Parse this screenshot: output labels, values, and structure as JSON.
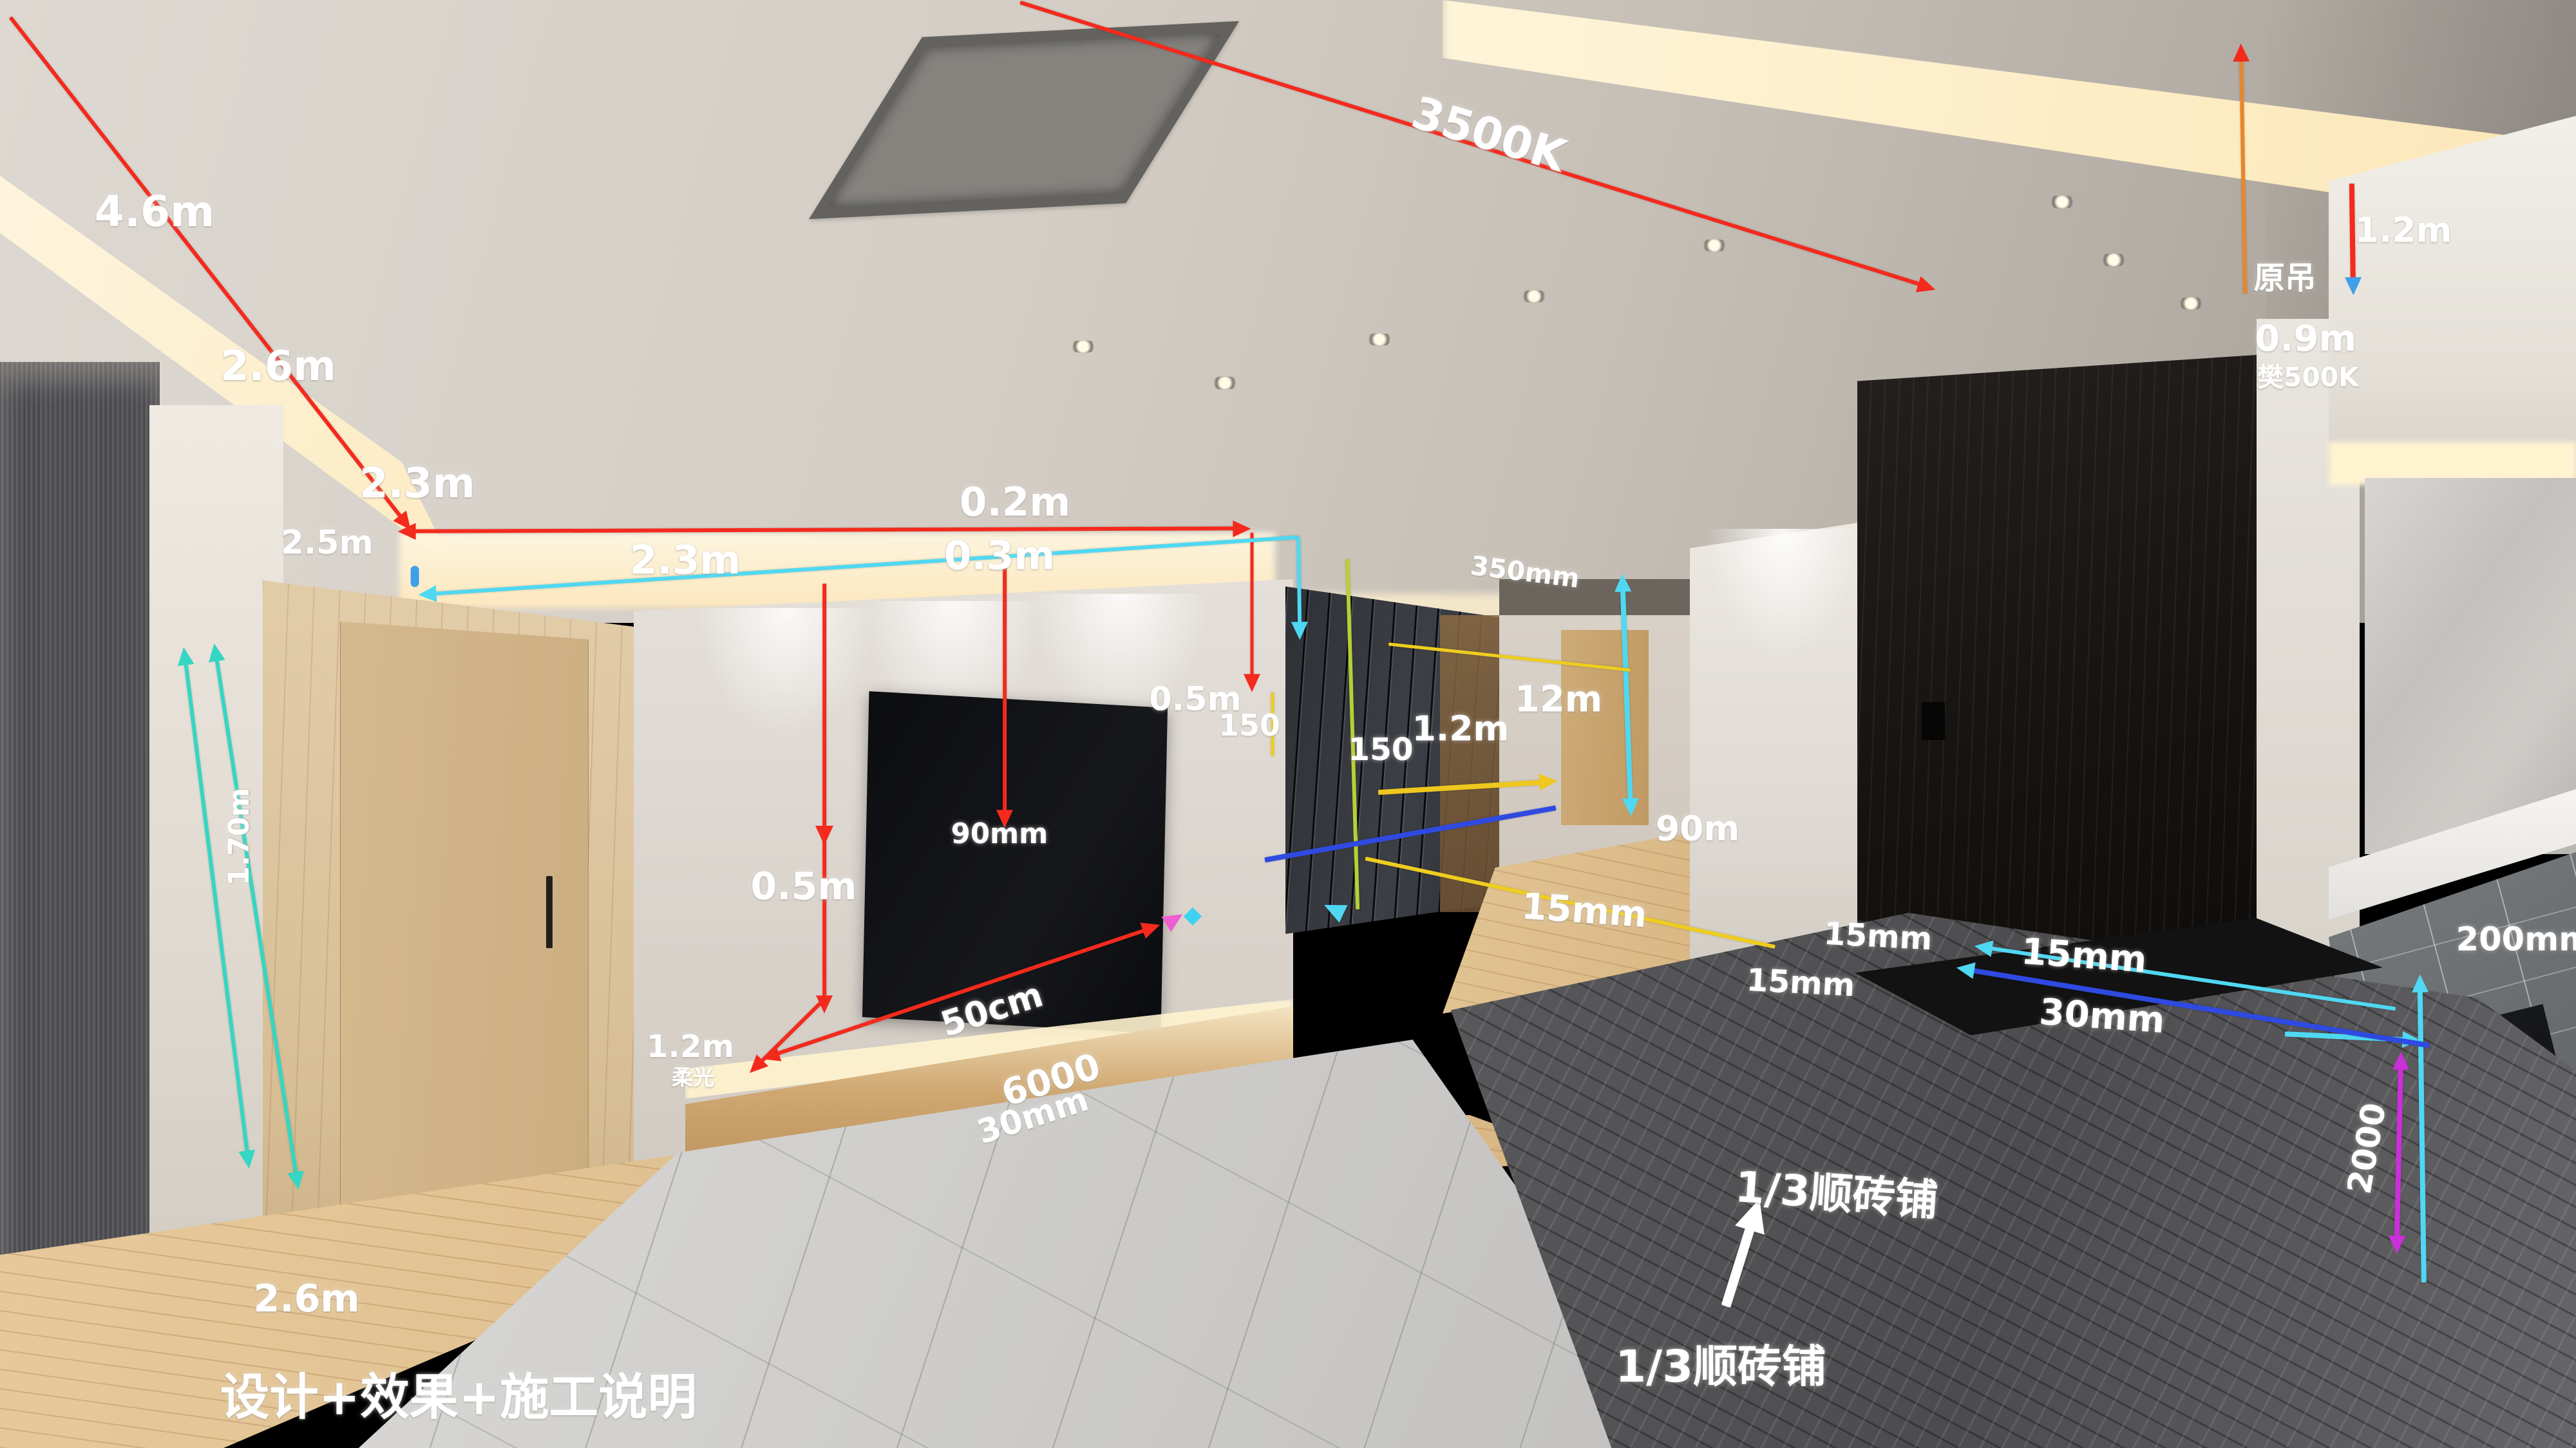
{
  "caption": {
    "text": "设计+效果+施工说明"
  },
  "colors": {
    "red": "#f42a1d",
    "cyan": "#4fd8f2",
    "teal": "#35d6c3",
    "yellow": "#eecd1f",
    "yellow_green": "#b8cf35",
    "blue": "#2f4ae0",
    "magenta": "#cb2fd9",
    "orange": "#e8862c",
    "light_blue": "#3f9fe8",
    "pink": "#ee5fd2",
    "white": "#ffffff"
  },
  "annotations": {
    "labels": [
      {
        "name": "dim-4-6m",
        "text": "4.6m",
        "x": 6.0,
        "y": 14.6,
        "size": 26,
        "rot": 0
      },
      {
        "name": "dim-2-6m-ceiling",
        "text": "2.6m",
        "x": 10.8,
        "y": 25.3,
        "size": 25,
        "rot": 0
      },
      {
        "name": "dim-2-3m-ceiling",
        "text": "2.3m",
        "x": 16.2,
        "y": 33.4,
        "size": 25,
        "rot": 0
      },
      {
        "name": "dim-2-5m",
        "text": "2.5m",
        "x": 12.7,
        "y": 37.5,
        "size": 20,
        "rot": 0
      },
      {
        "name": "dim-0-2m",
        "text": "0.2m",
        "x": 39.4,
        "y": 34.7,
        "size": 24,
        "rot": 0
      },
      {
        "name": "dim-0-3m",
        "text": "0.3m",
        "x": 38.8,
        "y": 38.4,
        "size": 24,
        "rot": 0
      },
      {
        "name": "dim-3500k",
        "text": "3500K",
        "x": 57.8,
        "y": 9.3,
        "size": 27,
        "rot": 17
      },
      {
        "name": "dim-2-3m-cove",
        "text": "2.3m",
        "x": 26.6,
        "y": 38.7,
        "size": 24,
        "rot": 0
      },
      {
        "name": "dim-1-70m",
        "text": "1.70m",
        "x": 9.3,
        "y": 57.8,
        "size": 17,
        "rot": -90
      },
      {
        "name": "dim-2-6m-floor",
        "text": "2.6m",
        "x": 11.9,
        "y": 89.7,
        "size": 23,
        "rot": 0
      },
      {
        "name": "dim-0-5m-tvwall",
        "text": "0.5m",
        "x": 31.2,
        "y": 61.2,
        "size": 23,
        "rot": 0
      },
      {
        "name": "dim-90mm",
        "text": "90mm",
        "x": 38.8,
        "y": 57.6,
        "size": 17,
        "rot": 0
      },
      {
        "name": "dim-50cm",
        "text": "50cm",
        "x": 38.5,
        "y": 69.7,
        "size": 21,
        "rot": -18
      },
      {
        "name": "dim-6000",
        "text": "6000",
        "x": 40.8,
        "y": 74.6,
        "size": 22,
        "rot": -17
      },
      {
        "name": "dim-30mm-console",
        "text": "30mm",
        "x": 40.1,
        "y": 77.1,
        "size": 20,
        "rot": -18
      },
      {
        "name": "dim-1-2m-console",
        "text": "1.2m",
        "x": 26.8,
        "y": 72.3,
        "size": 19,
        "rot": 0
      },
      {
        "name": "label-rouguang",
        "text": "柔光",
        "x": 26.9,
        "y": 74.3,
        "size": 13,
        "rot": 0
      },
      {
        "name": "dim-150-tvwall",
        "text": "150",
        "x": 48.5,
        "y": 50.1,
        "size": 18,
        "rot": 0
      },
      {
        "name": "dim-0-5m-cabinet",
        "text": "0.5m",
        "x": 46.4,
        "y": 48.3,
        "size": 20,
        "rot": 0
      },
      {
        "name": "dim-350mm",
        "text": "350mm",
        "x": 59.2,
        "y": 39.5,
        "size": 16,
        "rot": 7
      },
      {
        "name": "dim-150-cabinet",
        "text": "150",
        "x": 53.6,
        "y": 51.8,
        "size": 19,
        "rot": 0
      },
      {
        "name": "dim-1-2m-cabinet",
        "text": "1.2m",
        "x": 56.7,
        "y": 50.3,
        "size": 21,
        "rot": 0
      },
      {
        "name": "dim-12m",
        "text": "12m",
        "x": 60.5,
        "y": 48.3,
        "size": 22,
        "rot": 0
      },
      {
        "name": "dim-90m",
        "text": "90m",
        "x": 65.9,
        "y": 57.2,
        "size": 21,
        "rot": 0
      },
      {
        "name": "dim-15mm-hall",
        "text": "15mm",
        "x": 61.5,
        "y": 62.9,
        "size": 22,
        "rot": 4
      },
      {
        "name": "dim-15mm-wall",
        "text": "15mm",
        "x": 72.9,
        "y": 64.7,
        "size": 19,
        "rot": 3
      },
      {
        "name": "dim-15mm-floor",
        "text": "15mm",
        "x": 69.9,
        "y": 67.9,
        "size": 19,
        "rot": 3
      },
      {
        "name": "dim-15mm-door",
        "text": "15mm",
        "x": 80.9,
        "y": 66.0,
        "size": 22,
        "rot": 4
      },
      {
        "name": "dim-30mm-door",
        "text": "30mm",
        "x": 81.6,
        "y": 70.2,
        "size": 22,
        "rot": 4
      },
      {
        "name": "label-yuandiao",
        "text": "原吊",
        "x": 88.7,
        "y": 19.0,
        "size": 19,
        "rot": 0
      },
      {
        "name": "dim-1-2m-right",
        "text": "1.2m",
        "x": 93.3,
        "y": 15.9,
        "size": 21,
        "rot": 0
      },
      {
        "name": "dim-0-9m",
        "text": "0.9m",
        "x": 89.5,
        "y": 23.4,
        "size": 22,
        "rot": 0
      },
      {
        "name": "dim-500k-right",
        "text": "樊500K",
        "x": 89.6,
        "y": 25.9,
        "size": 16,
        "rot": 0
      },
      {
        "name": "dim-200mm",
        "text": "200mm",
        "x": 98.0,
        "y": 64.9,
        "size": 20,
        "rot": 0
      },
      {
        "name": "dim-2000",
        "text": "2000",
        "x": 91.9,
        "y": 79.3,
        "size": 20,
        "rot": -80
      },
      {
        "name": "label-tile-layout-upper",
        "text": "1/3顺砖铺",
        "x": 71.3,
        "y": 82.2,
        "size": 26,
        "rot": 4,
        "b": 1
      },
      {
        "name": "label-tile-layout-lower",
        "text": "1/3顺砖铺",
        "x": 66.8,
        "y": 94.1,
        "size": 27,
        "rot": 0,
        "b": 1
      },
      {
        "name": "caption-main",
        "text": "设计+效果+施工说明",
        "x": 17.8,
        "y": 96.2,
        "size": 30,
        "rot": 0,
        "b": 1
      }
    ],
    "lines": [
      {
        "name": "red-diag-left",
        "x1": 0.4,
        "y1": 1.2,
        "x2": 15.6,
        "y2": 35.8,
        "color": "#f42a1d",
        "w": 2.5,
        "a2": 1
      },
      {
        "name": "red-horiz-cove",
        "x1": 16.0,
        "y1": 36.7,
        "x2": 48.0,
        "y2": 36.5,
        "color": "#f42a1d",
        "w": 2.5,
        "a1": 1,
        "a2": 1
      },
      {
        "name": "red-diag-3500k",
        "x1": 39.6,
        "y1": 0.2,
        "x2": 74.6,
        "y2": 19.7,
        "color": "#f42a1d",
        "w": 2.5,
        "a2": 1
      },
      {
        "name": "red-vert-tvwall",
        "x1": 32.0,
        "y1": 40.3,
        "x2": 32.0,
        "y2": 69.0,
        "color": "#f42a1d",
        "w": 2.5,
        "a2": 1
      },
      {
        "name": "red-diag-tvbase",
        "x1": 32.0,
        "y1": 69.0,
        "x2": 29.5,
        "y2": 73.4,
        "color": "#f42a1d",
        "w": 2.5,
        "a2": 1
      },
      {
        "name": "red-vert-tvright",
        "x1": 39.0,
        "y1": 37.6,
        "x2": 39.0,
        "y2": 56.2,
        "color": "#f42a1d",
        "w": 2.5,
        "a2": 1
      },
      {
        "name": "red-console-arrow",
        "x1": 30.1,
        "y1": 72.8,
        "x2": 44.5,
        "y2": 64.2,
        "color": "#f42a1d",
        "w": 2.5,
        "a1": 1,
        "a2": 1
      },
      {
        "name": "red-vert-cabinet",
        "x1": 48.6,
        "y1": 36.8,
        "x2": 48.6,
        "y2": 46.8,
        "color": "#f42a1d",
        "w": 2,
        "a2": 1
      },
      {
        "name": "orange-vert-yuandiao",
        "x1": 87.0,
        "y1": 4.0,
        "x2": 87.15,
        "y2": 20.3,
        "color": "#e8862c",
        "w": 2.5,
        "a1": 1,
        "ac": "#f42a1d"
      },
      {
        "name": "red-vert-right-edge",
        "x1": 91.3,
        "y1": 12.7,
        "x2": 91.35,
        "y2": 19.4,
        "color": "#f42a1d",
        "w": 3,
        "a2": 1,
        "ac": "#3f9fe8"
      },
      {
        "name": "cyan-cove-line",
        "x1": 16.8,
        "y1": 41.0,
        "x2": 50.4,
        "y2": 37.1,
        "color": "#4fd8f2",
        "w": 2.5,
        "a1": 1
      },
      {
        "name": "cyan-cabinet-corner",
        "x1": 50.4,
        "y1": 37.1,
        "x2": 50.45,
        "y2": 43.2,
        "color": "#4fd8f2",
        "w": 2.5,
        "a2": 1
      },
      {
        "name": "cyan-vert-doorframe",
        "x1": 63.0,
        "y1": 40.6,
        "x2": 63.3,
        "y2": 55.4,
        "color": "#4fd8f2",
        "w": 3,
        "a1": 1,
        "a2": 1
      },
      {
        "name": "cyan-doorbase-line",
        "x1": 77.2,
        "y1": 65.5,
        "x2": 93.0,
        "y2": 69.7,
        "color": "#4fd8f2",
        "w": 2.5,
        "a1": 1
      },
      {
        "name": "cyan-horiz-kitchen",
        "x1": 88.7,
        "y1": 71.4,
        "x2": 93.4,
        "y2": 71.8,
        "color": "#4fd8f2",
        "w": 3,
        "a2": 1
      },
      {
        "name": "cyan-vert-kitchen",
        "x1": 93.95,
        "y1": 68.3,
        "x2": 94.1,
        "y2": 88.6,
        "color": "#4fd8f2",
        "w": 3,
        "a1": 1
      },
      {
        "name": "teal-vert-left-1",
        "x1": 7.2,
        "y1": 45.7,
        "x2": 9.6,
        "y2": 79.7,
        "color": "#35d6c3",
        "w": 2.5,
        "a1": 1,
        "a2": 1
      },
      {
        "name": "teal-vert-left-2",
        "x1": 8.4,
        "y1": 45.4,
        "x2": 11.5,
        "y2": 81.2,
        "color": "#35d6c3",
        "w": 2.5,
        "a1": 1,
        "a2": 1
      },
      {
        "name": "yellow-cabinet-cove",
        "x1": 53.9,
        "y1": 44.5,
        "x2": 63.3,
        "y2": 46.3,
        "color": "#eecd1f",
        "w": 2
      },
      {
        "name": "green-vert-cabinet",
        "x1": 52.3,
        "y1": 38.6,
        "x2": 52.7,
        "y2": 62.8,
        "color": "#b8cf35",
        "w": 2.5
      },
      {
        "name": "yellow-arrow-cabinet",
        "x1": 53.5,
        "y1": 54.7,
        "x2": 59.9,
        "y2": 54.0,
        "color": "#eec81f",
        "w": 3,
        "a2": 1
      },
      {
        "name": "yellow-floor-line",
        "x1": 53.0,
        "y1": 59.3,
        "x2": 68.9,
        "y2": 65.4,
        "color": "#eecd1f",
        "w": 2.5
      },
      {
        "name": "yellow-tick-150",
        "x1": 49.4,
        "y1": 47.8,
        "x2": 49.4,
        "y2": 52.2,
        "color": "#eecd1f",
        "w": 2
      },
      {
        "name": "blue-cabinet-base",
        "x1": 49.1,
        "y1": 59.4,
        "x2": 60.4,
        "y2": 55.8,
        "color": "#2f4ae0",
        "w": 3
      },
      {
        "name": "blue-doorbase-line",
        "x1": 76.5,
        "y1": 67.0,
        "x2": 94.3,
        "y2": 72.2,
        "color": "#2f4ae0",
        "w": 3,
        "a1": 1,
        "ac": "#4fd8f2"
      },
      {
        "name": "magenta-vert-kitchen",
        "x1": 93.2,
        "y1": 73.6,
        "x2": 93.05,
        "y2": 85.6,
        "color": "#cb2fd9",
        "w": 3,
        "a1": 1,
        "a2": 1
      },
      {
        "name": "white-arrow-tile",
        "x1": 67.0,
        "y1": 90.2,
        "x2": 68.0,
        "y2": 84.5,
        "color": "#ffffff",
        "w": 6,
        "a2": 1,
        "as": 20
      }
    ],
    "marks": [
      {
        "name": "blue-capsule-cove",
        "type": "capsule",
        "x": 16.1,
        "y": 39.8,
        "color": "#3f9fe8"
      },
      {
        "name": "red-mid-arrow",
        "type": "arrow",
        "x": 32.0,
        "y": 57.3,
        "rot": 90,
        "color": "#f42a1d",
        "size": 12
      },
      {
        "name": "pink-arrowhead",
        "type": "arrow",
        "x": 45.4,
        "y": 63.7,
        "rot": -32,
        "color": "#ee5fd2",
        "size": 12
      },
      {
        "name": "cyan-diamond",
        "type": "diamond",
        "x": 46.3,
        "y": 63.3,
        "color": "#3fd2ee"
      },
      {
        "name": "cyan-arrow-cabinet-foot",
        "type": "arrow",
        "x": 52.0,
        "y": 63.0,
        "rot": 205,
        "color": "#4fd8f2",
        "size": 13
      }
    ]
  }
}
